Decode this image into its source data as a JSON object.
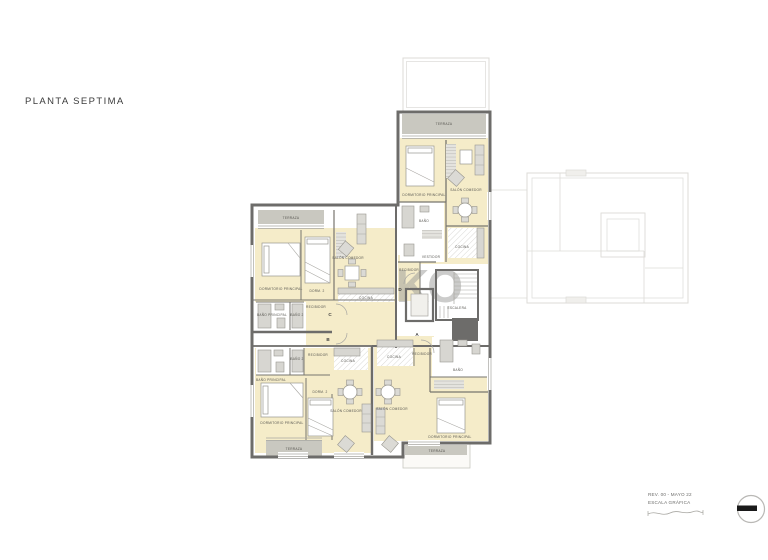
{
  "title": "PLANTA SEPTIMA",
  "watermark": "KO",
  "units": {
    "a": {
      "letter": "A",
      "rooms": {
        "recibidor": "RECIBIDOR",
        "cocina": "COCINA",
        "bano": "BAÑO",
        "dormitorio_principal": "DORMITORIO PRINCIPAL",
        "salon_comedor": "SALÓN COMEDOR",
        "terraza": "TERRAZA"
      }
    },
    "b": {
      "letter": "B",
      "rooms": {
        "recibidor": "RECIBIDOR",
        "cocina": "COCINA",
        "bano_principal": "BAÑO PRINCIPAL",
        "bano_2": "BAÑO 2",
        "dormitorio_principal": "DORMITORIO PRINCIPAL",
        "dorm_2": "DORM. 2",
        "salon_comedor": "SALÓN COMEDOR",
        "terraza": "TERRAZA"
      }
    },
    "c": {
      "letter": "C",
      "rooms": {
        "terraza": "TERRAZA",
        "dormitorio_principal": "DORMITORIO PRINCIPAL",
        "dorm_2": "DORM. 2",
        "salon_comedor": "SALÓN COMEDOR",
        "cocina": "COCINA",
        "recibidor": "RECIBIDOR",
        "bano_principal": "BAÑO PRINCIPAL",
        "bano_2": "BAÑO 2"
      }
    },
    "d": {
      "letter": "D",
      "rooms": {
        "terraza": "TERRAZA",
        "dormitorio_principal": "DORMITORIO PRINCIPAL",
        "salon_comedor": "SALÓN COMEDOR",
        "cocina": "COCINA",
        "bano": "BAÑO",
        "vestidor": "VESTIDOR",
        "recibidor": "RECIBIDOR"
      }
    }
  },
  "core": {
    "escalera": "ESCALERA"
  },
  "titleblock": {
    "revision": "REV. 00 - MAYO 22",
    "scale_label": "ESCALA GRÁFICA"
  },
  "colors": {
    "room_fill": "#f5ecc9",
    "wall": "#6d6c6a",
    "terrace_fill": "#c9c8c0",
    "fixture": "#d7d6d1",
    "faint_line": "#dcdbd7",
    "text": "#4a4a48"
  }
}
